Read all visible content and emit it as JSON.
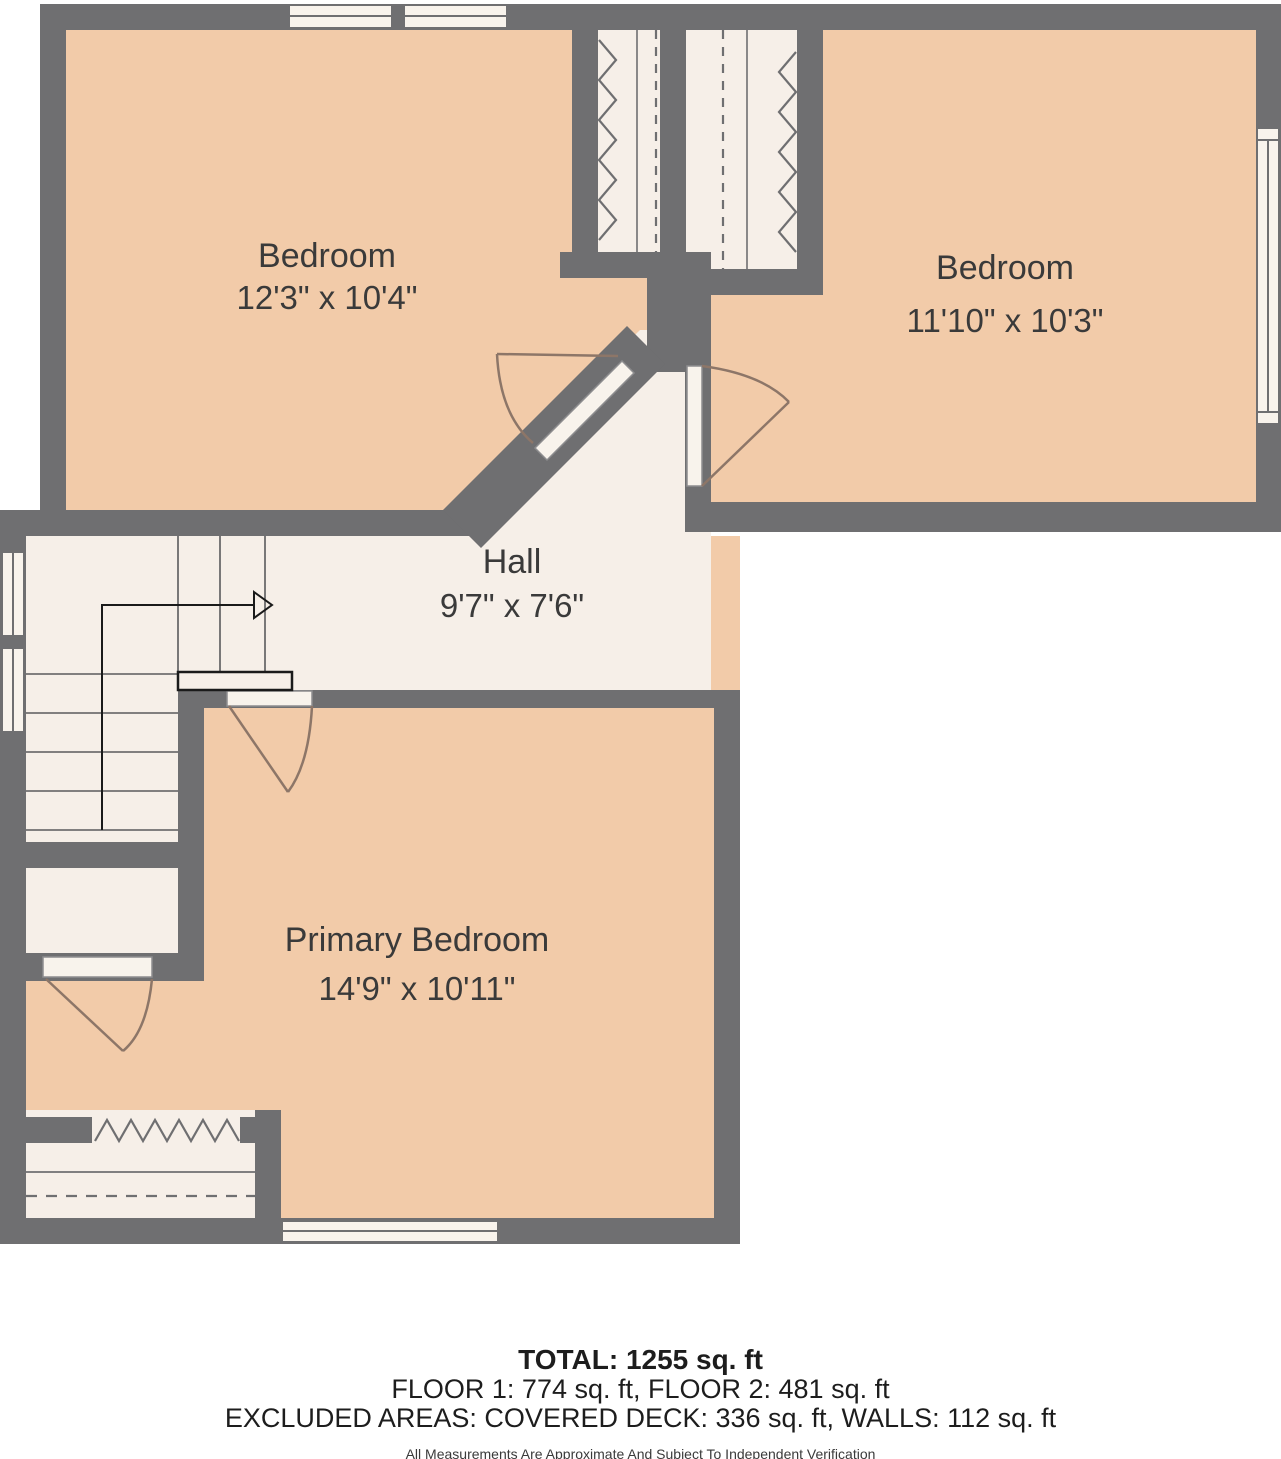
{
  "plan": {
    "rooms": [
      {
        "id": "bedroom-top-left",
        "name": "Bedroom",
        "dims": "12'3\" x 10'4\""
      },
      {
        "id": "bedroom-top-right",
        "name": "Bedroom",
        "dims": "11'10\" x 10'3\""
      },
      {
        "id": "hall",
        "name": "Hall",
        "dims": "9'7\" x 7'6\""
      },
      {
        "id": "primary-bedroom",
        "name": "Primary Bedroom",
        "dims": "14'9\" x 10'11\""
      }
    ],
    "colors": {
      "wall": "#6F6F71",
      "room_fill": "#F2CBA9",
      "hall_fill": "#F6EFE8",
      "door_arc": "#8D7668",
      "text": "#3A3A3A"
    }
  },
  "footer": {
    "total": "TOTAL: 1255 sq. ft",
    "floors": "FLOOR 1: 774 sq. ft, FLOOR 2: 481 sq. ft",
    "excluded": "EXCLUDED AREAS: COVERED DECK: 336 sq. ft, WALLS: 112 sq. ft",
    "disclaimer": "All Measurements Are Approximate And Subject To Independent Verification"
  }
}
